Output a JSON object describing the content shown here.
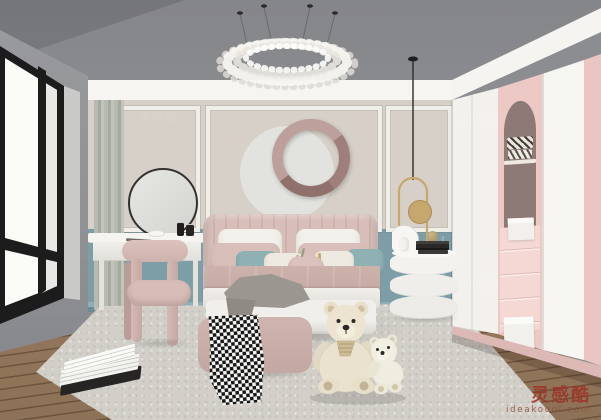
{
  "scene": {
    "type": "3d interior render",
    "room": "pink and blue kids bedroom",
    "objects": [
      "chandelier",
      "pendant-light",
      "window",
      "curtain-panel",
      "wall-circle-decor",
      "vanity-mirror",
      "vanity-table",
      "vanity-stool",
      "bed",
      "pillows",
      "duvet",
      "throw-blanket",
      "bench",
      "houndstooth-blanket",
      "teddy-bear-large",
      "teddy-bear-small",
      "nightstand",
      "cat-figurine",
      "book-stack",
      "wardrobe",
      "arch-niche",
      "drawer-stack",
      "rug",
      "wood-floor",
      "magazine"
    ]
  },
  "watermark": {
    "brand": "灵感酷",
    "domain": "ideakoool.com",
    "brand_color": "#9c3226"
  },
  "palette": {
    "ceiling": "#8b8c90",
    "left_wall": "#96979b",
    "wall_upper_greige": "#d6d0c8",
    "wall_lower_blue": "#7d9da7",
    "molding_white": "#f1f0ec",
    "ring_pink": "#bda09c",
    "circle_light": "#e2e2de",
    "headboard_pink": "#d5bab5",
    "duvet_pink": "#c8aea8",
    "pillow_teal": "#8fb1b4",
    "bench_pink": "#c8ada9",
    "wardrobe_white": "#f5f4f1",
    "wardrobe_pink": "#ecc9c5",
    "niche_mauve": "#8d7975",
    "drawer_pink": "#f3d3cf",
    "pendant_gold": "#c6a76e",
    "floor_wood": "#9c8165",
    "rug": "#d2cfc9"
  }
}
